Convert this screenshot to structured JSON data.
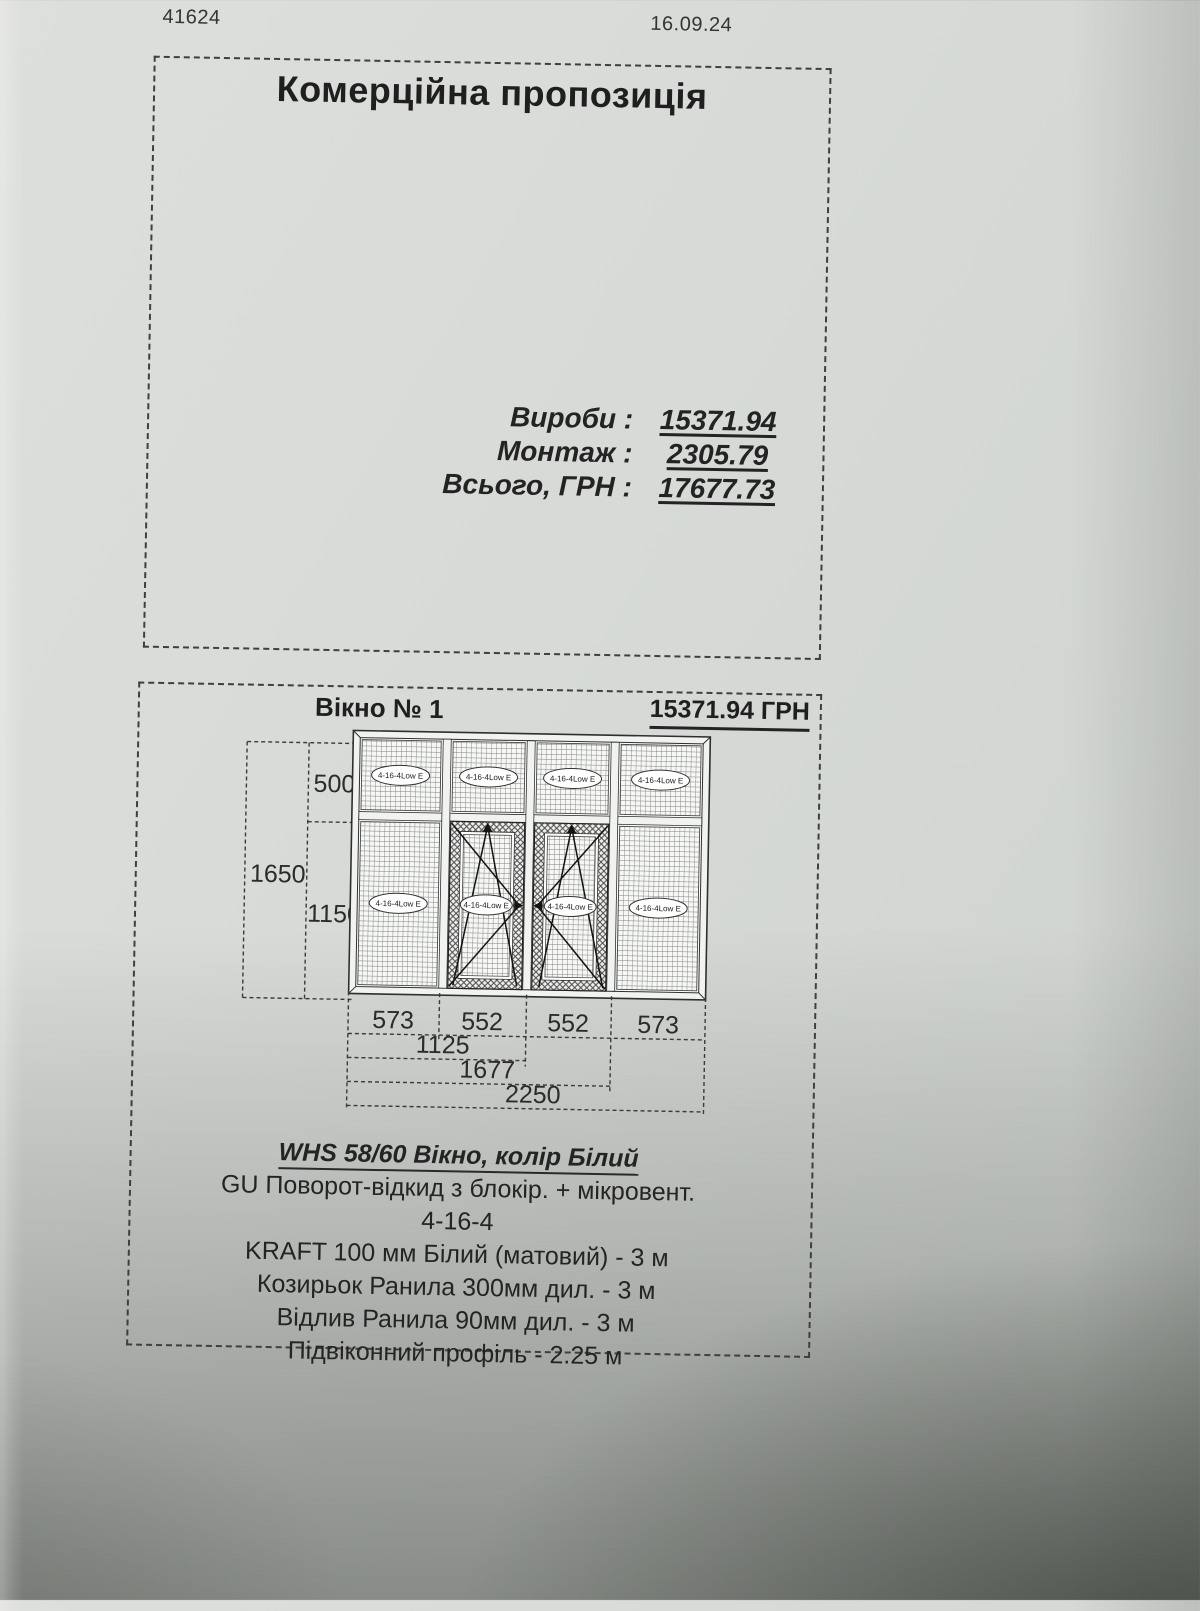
{
  "page": {
    "doc_number": "41624",
    "date": "16.09.24",
    "title": "Комерційна пропозиція",
    "totals": {
      "rows": [
        {
          "label": "Вироби :",
          "value": "15371.94"
        },
        {
          "label": "Монтаж :",
          "value": "2305.79"
        },
        {
          "label": "Всього, ГРН :",
          "value": "17677.73"
        }
      ]
    },
    "window_section": {
      "name": "Вікно № 1",
      "price": "15371.94 ГРН",
      "diagram": {
        "height_total": "1650",
        "height_top": "500",
        "height_bottom": "1150",
        "widths": [
          "573",
          "552",
          "552",
          "573"
        ],
        "width_groups": [
          "1125",
          "1677",
          "2250"
        ],
        "glass_label": "4-16-4Low E"
      },
      "description": [
        "WHS 58/60 Вікно, колір Білий",
        "GU Поворот-відкид з блокір. + мікровент.",
        "4-16-4",
        "KRAFT 100 мм Білий (матовий) - 3 м",
        "Козирьок Ранила 300мм дил. - 3 м",
        "Відлив Ранила 90мм дил. - 3 м",
        "Підвіконний профіль - 2.25 м"
      ]
    }
  }
}
